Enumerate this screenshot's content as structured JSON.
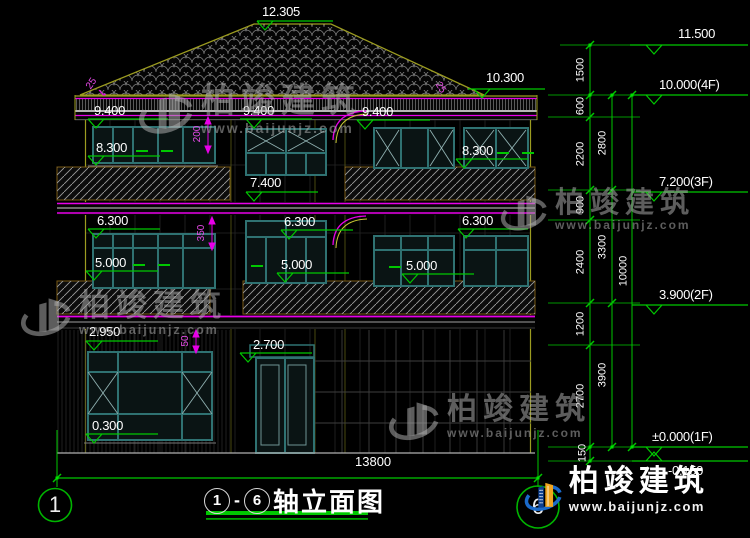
{
  "watermark": {
    "brand": "柏竣建筑",
    "url": "www.baijunjz.com"
  },
  "facade_markers": [
    {
      "label": "12.305"
    },
    {
      "label": "9.400"
    },
    {
      "label": "9.400"
    },
    {
      "label": "9.400"
    },
    {
      "label": "8.300"
    },
    {
      "label": "8.300"
    },
    {
      "label": "7.400"
    },
    {
      "label": "6.300"
    },
    {
      "label": "6.300"
    },
    {
      "label": "6.300"
    },
    {
      "label": "5.000"
    },
    {
      "label": "5.000"
    },
    {
      "label": "5.000"
    },
    {
      "label": "2.950"
    },
    {
      "label": "2.700"
    },
    {
      "label": "0.300"
    }
  ],
  "right_markers": [
    {
      "label": "11.500"
    },
    {
      "label": "10.300"
    },
    {
      "label": "10.000(4F)"
    },
    {
      "label": "7.200(3F)"
    },
    {
      "label": "3.900(2F)"
    },
    {
      "label": "±0.000(1F)"
    },
    {
      "label": "-0.150"
    }
  ],
  "dim_chains": {
    "inner": [
      "1500",
      "600",
      "2200",
      "900",
      "2400",
      "1200",
      "2700",
      "150"
    ],
    "middle": [
      "2800",
      "3300",
      "3900"
    ],
    "overall": "10000"
  },
  "detail_dims": [
    {
      "label": "200"
    },
    {
      "label": "350"
    },
    {
      "label": "50"
    },
    {
      "label": "25"
    },
    {
      "label": "25"
    }
  ],
  "bottom": {
    "overall_width": "13800",
    "axis_left": "1",
    "axis_right": "6",
    "title": {
      "start_axis": "1",
      "dash": "-",
      "end_axis": "6",
      "text": "轴立面图"
    }
  },
  "colors": {
    "dim_green": "#00c800",
    "magenta": "#e800e8",
    "roof_olive": "#9c9c20",
    "window_teal": "#2f7272",
    "logo_blue": "#1b6ac9",
    "logo_dark_blue": "#0d3f8f",
    "logo_orange": "#f0a41e"
  }
}
